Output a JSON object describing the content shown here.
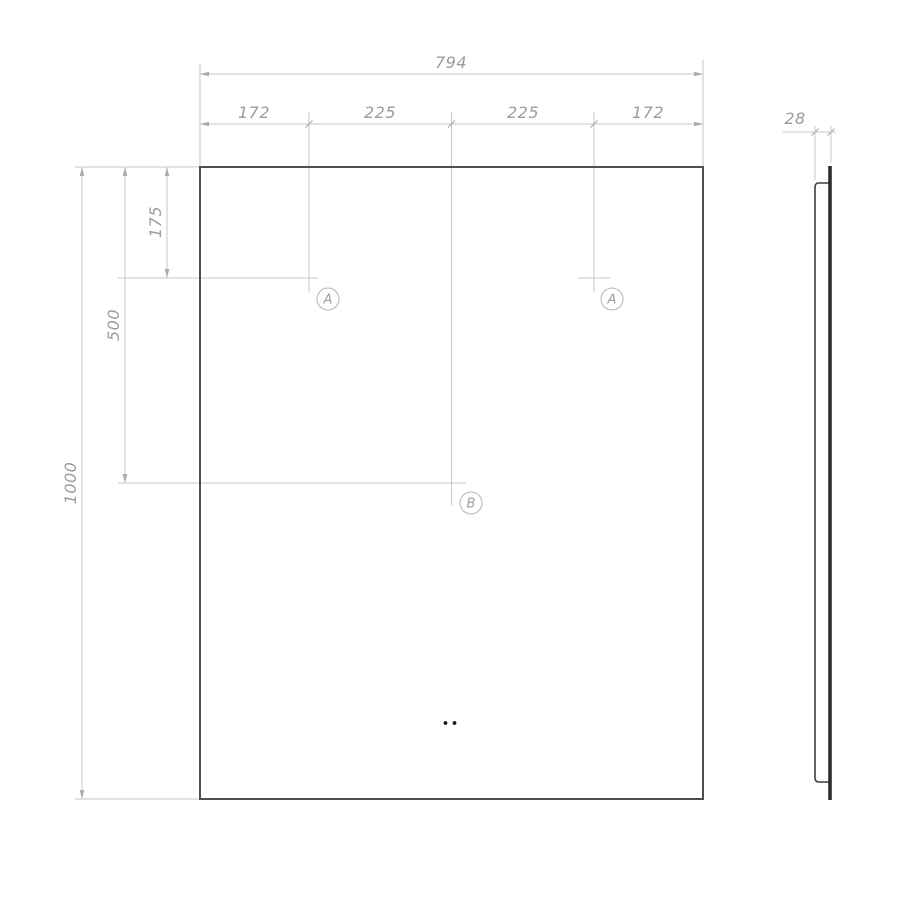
{
  "front_view": {
    "overall_width": "794",
    "segment_dims": [
      "172",
      "225",
      "225",
      "172"
    ],
    "overall_height": "1000",
    "hole_b_from_top": "500",
    "hole_a_from_top": "175",
    "hole_a1_label": "A",
    "hole_a2_label": "A",
    "hole_b_label": "B"
  },
  "side_view": {
    "depth": "28"
  },
  "colors": {
    "background": "#ffffff",
    "part_outline": "#4f4f4f",
    "dimension_lines": "#c7c7c7",
    "dimension_text": "#9b9b9b",
    "side_glass": "#2e2e2e",
    "sensor_dots": "#141414"
  }
}
